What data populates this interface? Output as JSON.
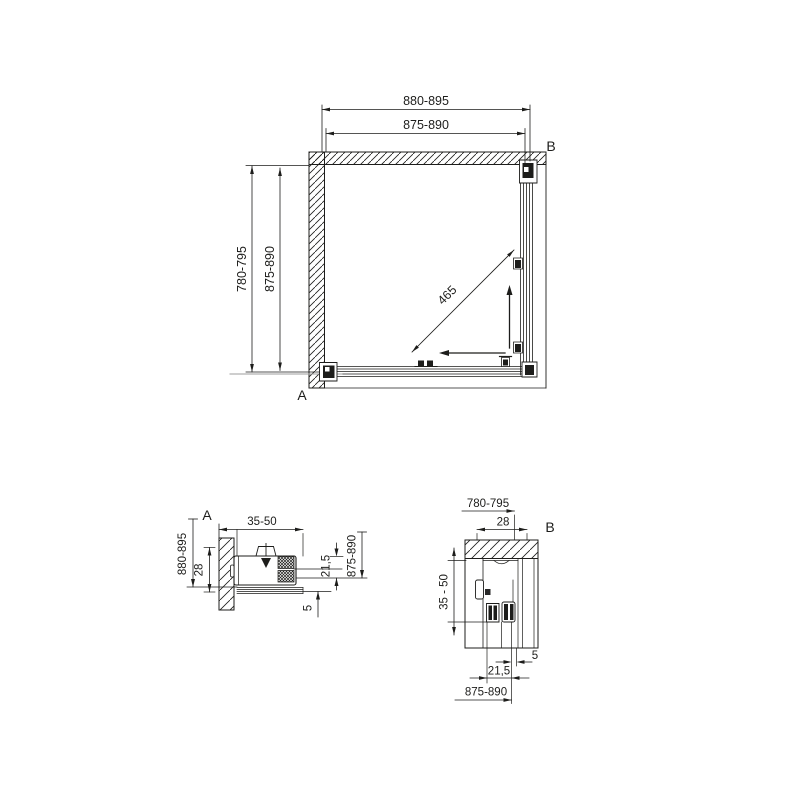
{
  "drawing": {
    "plan_view": {
      "label_a": "A",
      "label_b": "B",
      "dims": {
        "width_outer": "880-895",
        "width_inner": "875-890",
        "depth_outer": "780-795",
        "depth_inner": "875-890",
        "diagonal": "465"
      }
    },
    "detail_a": {
      "label": "A",
      "dims": {
        "top": "35-50",
        "left_outer": "880-895",
        "left_inner": "28",
        "right_outer": "875-890",
        "right_inner": "21,5",
        "bottom": "5"
      }
    },
    "detail_b": {
      "label": "B",
      "dims": {
        "top_outer": "780-795",
        "top_inner": "28",
        "left": "35 - 50",
        "right_gap": "5",
        "bottom_inner": "21,5",
        "bottom_outer": "875-890"
      }
    },
    "colors": {
      "line": "#1d1d1b",
      "centerline": "#9c9c9c",
      "background": "#ffffff"
    }
  }
}
